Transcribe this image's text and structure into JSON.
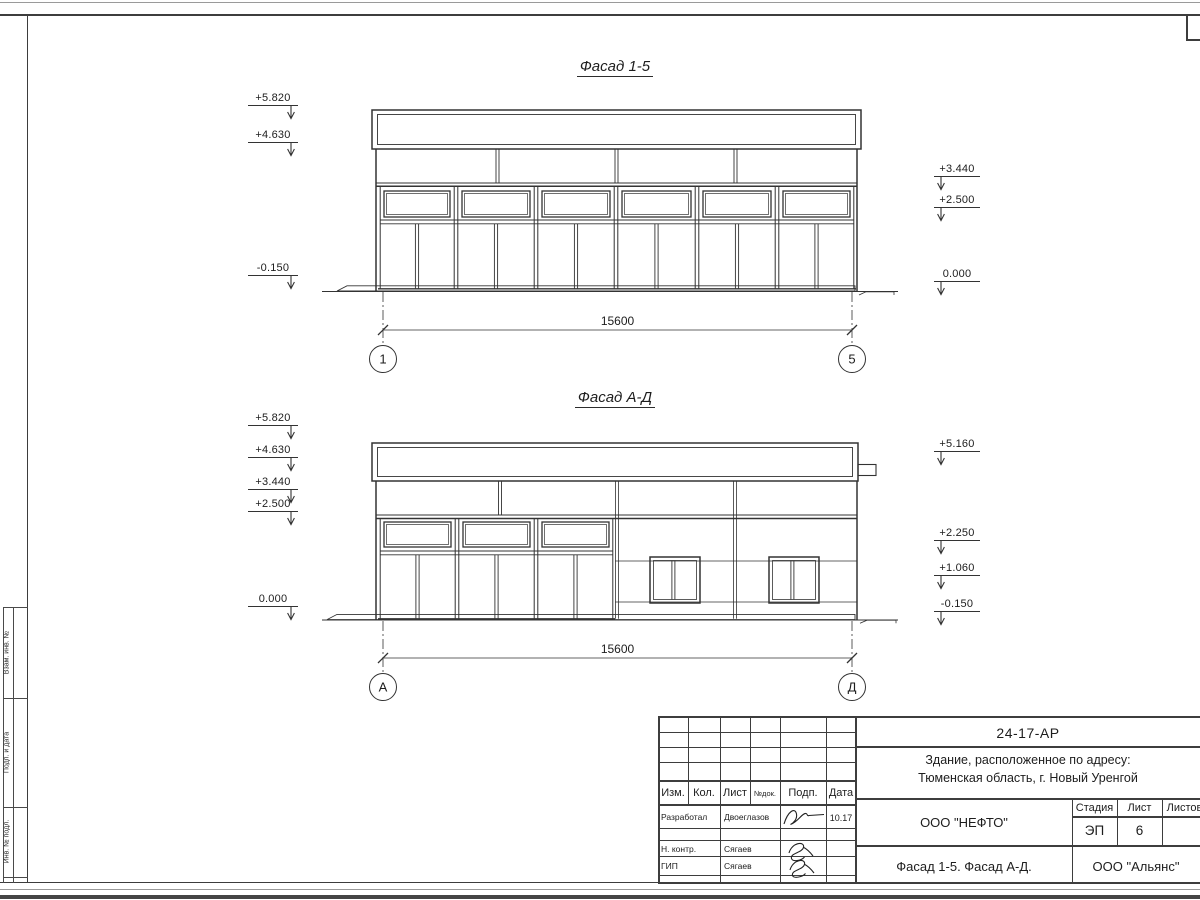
{
  "frame": {
    "side_labels": [
      "Взам. инв. №",
      "Подп. и дата",
      "Инв. № подл."
    ]
  },
  "facade1": {
    "title": "Фасад 1-5",
    "marks_left": [
      "+5.820",
      "+4.630",
      "-0.150"
    ],
    "marks_right": [
      "+3.440",
      "+2.500",
      "0.000"
    ],
    "dim": "15600",
    "axis_left": "1",
    "axis_right": "5"
  },
  "facade2": {
    "title": "Фасад А-Д",
    "marks_left": [
      "+5.820",
      "+4.630",
      "+3.440",
      "+2.500",
      "0.000"
    ],
    "marks_right": [
      "+5.160",
      "+2.250",
      "+1.060",
      "-0.150"
    ],
    "dim": "15600",
    "axis_left": "А",
    "axis_right": "Д"
  },
  "titleblock": {
    "doc_number": "24-17-АР",
    "address_line1": "Здание, расположенное по адресу:",
    "address_line2": "Тюменская область, г. Новый Уренгой",
    "header": [
      "Изм.",
      "Кол.",
      "Лист",
      "№док.",
      "Подп.",
      "Дата"
    ],
    "rows": [
      {
        "role": "Разработал",
        "name": "Двоеглазов",
        "date": "10.17"
      },
      {
        "role": "Н. контр.",
        "name": "Сягаев",
        "date": ""
      },
      {
        "role": "ГИП",
        "name": "Сягаев",
        "date": ""
      }
    ],
    "org_center": "ООО \"НЕФТО\"",
    "sheet_title": "Фасад 1-5. Фасад А-Д.",
    "org_right": "ООО \"Альянс\"",
    "stage_label": "Стадия",
    "sheet_label": "Лист",
    "sheets_label": "Листов",
    "stage": "ЭП",
    "sheet_no": "6"
  }
}
